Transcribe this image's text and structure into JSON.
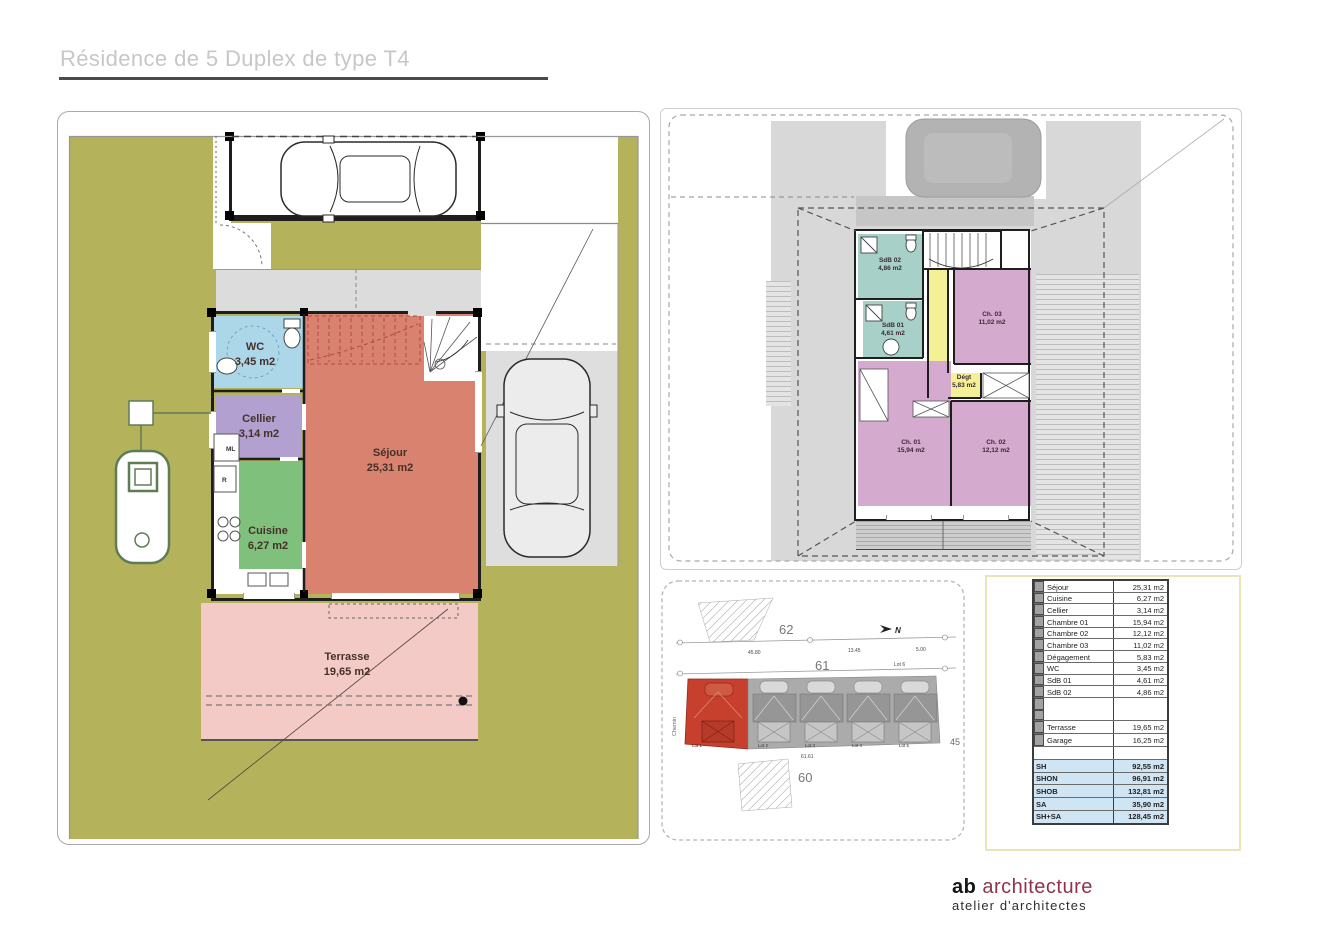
{
  "page": {
    "title": "Résidence de 5 Duplex de type T4"
  },
  "ground_floor": {
    "rooms": {
      "wc": {
        "name": "WC",
        "area": "3,45 m2"
      },
      "cellier": {
        "name": "Cellier",
        "area": "3,14 m2"
      },
      "cuisine": {
        "name": "Cuisine",
        "area": "6,27 m2"
      },
      "sejour": {
        "name": "Séjour",
        "area": "25,31 m2"
      },
      "terrasse": {
        "name": "Terrasse",
        "area": "19,65 m2"
      }
    },
    "appliances": {
      "washer": "ML",
      "fridge": "R"
    }
  },
  "upper_floor": {
    "rooms": {
      "sdb02": {
        "name": "SdB 02",
        "area": "4,86 m2"
      },
      "sdb01": {
        "name": "SdB 01",
        "area": "4,61 m2"
      },
      "ch03": {
        "name": "Ch. 03",
        "area": "11,02 m2"
      },
      "degagement": {
        "name": "Dégt",
        "area": "5,83 m2"
      },
      "ch01": {
        "name": "Ch. 01",
        "area": "15,94 m2"
      },
      "ch02": {
        "name": "Ch. 02",
        "area": "12,12 m2"
      }
    }
  },
  "site_plan": {
    "parcel_north": "62",
    "parcel_road": "61",
    "parcel_south": "60",
    "lots": [
      "Lot 1",
      "Lot 2",
      "Lot 3",
      "Lot 4",
      "Lot 5"
    ],
    "lot6": "Lot 6",
    "street_name": "Chemin",
    "north_label": "N",
    "dim_top_left": "45.80",
    "dim_top_mid": "13.45",
    "dim_top_right": "5.00",
    "dim_bottom": "61.61",
    "dim_right": "45"
  },
  "area_table": {
    "rooms": [
      {
        "label": "Séjour",
        "value": "25,31 m2"
      },
      {
        "label": "Cuisine",
        "value": "6,27 m2"
      },
      {
        "label": "Cellier",
        "value": "3,14 m2"
      },
      {
        "label": "Chambre 01",
        "value": "15,94 m2"
      },
      {
        "label": "Chambre 02",
        "value": "12,12 m2"
      },
      {
        "label": "Chambre 03",
        "value": "11,02 m2"
      },
      {
        "label": "Dégagement",
        "value": "5,83 m2"
      },
      {
        "label": "WC",
        "value": "3,45 m2"
      },
      {
        "label": "SdB 01",
        "value": "4,61 m2"
      },
      {
        "label": "SdB 02",
        "value": "4,86 m2"
      }
    ],
    "exterior": [
      {
        "label": "Terrasse",
        "value": "19,65 m2"
      },
      {
        "label": "Garage",
        "value": "16,25 m2"
      }
    ],
    "summary": [
      {
        "label": "SH",
        "value": "92,55 m2"
      },
      {
        "label": "SHON",
        "value": "96,91 m2"
      },
      {
        "label": "SHOB",
        "value": "132,81 m2"
      },
      {
        "label": "SA",
        "value": "35,90 m2"
      },
      {
        "label": "SH+SA",
        "value": "128,45 m2"
      }
    ]
  },
  "footer": {
    "brand_bold": "ab",
    "brand_name": " architecture",
    "subtitle": "atelier d'architectes"
  },
  "colors": {
    "olive": "#b5b25c",
    "sejour": "#d9826f",
    "terrasse": "#f3cac6",
    "wc_blue": "#abd7e9",
    "cellier_purple": "#b2a0d0",
    "cuisine_green": "#7fc17c",
    "bedroom_mauve": "#d4abce",
    "bath_teal": "#a6d0c8",
    "degagement_yellow": "#f4f096",
    "lot_red": "#c7402e",
    "summary_blue": "#cfe5f3",
    "logo_red": "#8e3448"
  }
}
